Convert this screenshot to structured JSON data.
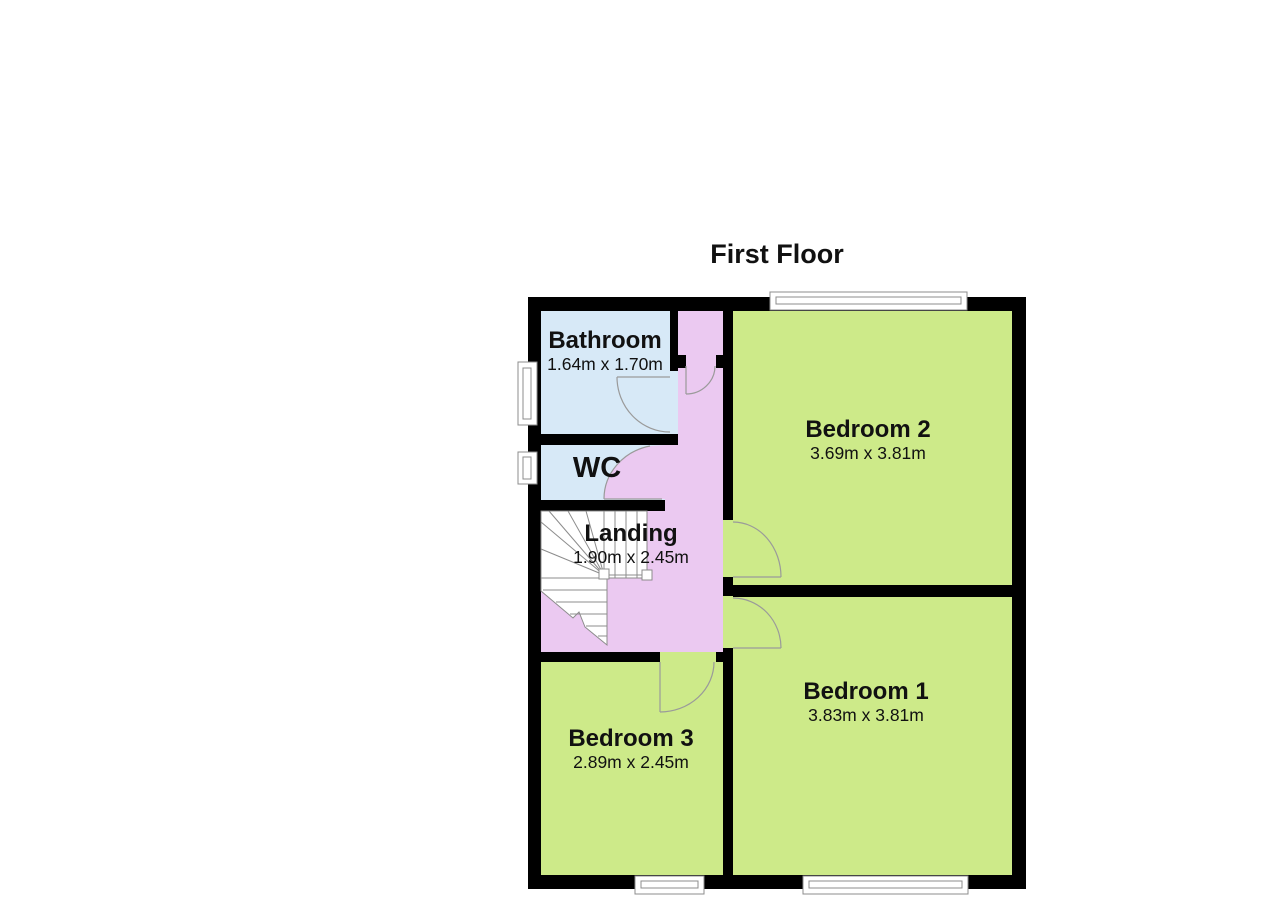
{
  "title": "First Floor",
  "colors": {
    "wall": "#000000",
    "bedroom_fill": "#cdea89",
    "wet_fill": "#d7e9f7",
    "landing_fill": "#ebc9f1",
    "stair_fill": "#ffffff",
    "window_fill": "#ffffff",
    "outline_gray": "#8c8c8c"
  },
  "rooms": {
    "bathroom": {
      "name": "Bathroom",
      "dims": "1.64m x 1.70m"
    },
    "wc": {
      "name": "WC"
    },
    "landing": {
      "name": "Landing",
      "dims": "1.90m x 2.45m"
    },
    "bedroom2": {
      "name": "Bedroom 2",
      "dims": "3.69m x 3.81m"
    },
    "bedroom1": {
      "name": "Bedroom 1",
      "dims": "3.83m x 3.81m"
    },
    "bedroom3": {
      "name": "Bedroom 3",
      "dims": "2.89m x 2.45m"
    }
  }
}
